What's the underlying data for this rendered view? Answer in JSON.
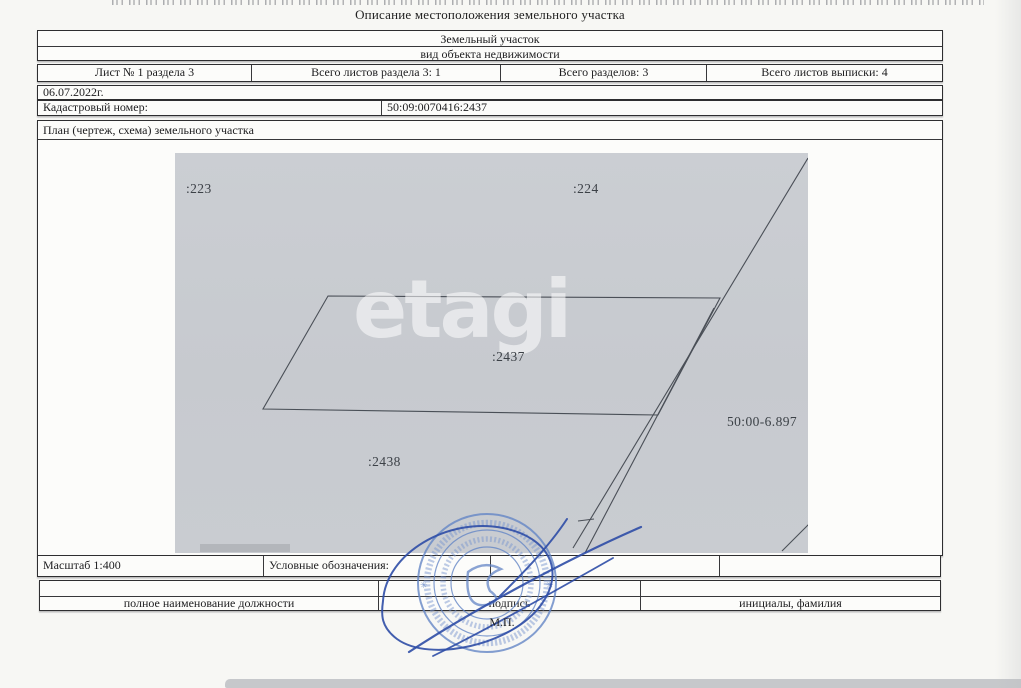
{
  "page": {
    "title": "Описание местоположения земельного участка"
  },
  "object_box": {
    "type": "Земельный участок",
    "caption": "вид объекта недвижимости"
  },
  "sheet_row": {
    "cells": [
      "Лист № 1 раздела 3",
      "Всего листов раздела 3: 1",
      "Всего разделов: 3",
      "Всего листов выписки: 4"
    ]
  },
  "date_row": {
    "value": "06.07.2022г."
  },
  "cadastral_row": {
    "label": "Кадастровый номер:",
    "value": "50:09:0070416:2437"
  },
  "plan": {
    "header": "План (чертеж, схема) земельного участка",
    "watermark": "etagi",
    "labels": {
      "parcel_223": ":223",
      "parcel_224": ":224",
      "parcel_2437": ":2437",
      "parcel_2438": ":2438",
      "boundary_zone": "50:00-6.897"
    }
  },
  "scale_row": {
    "scale": "Масштаб 1:400",
    "legend_label": "Условные обозначения:"
  },
  "signature_table": {
    "position_label": "полное наименование должности",
    "signature_label": "подпись",
    "name_label": "инициалы, фамилия",
    "seal_mark": "М.П."
  },
  "seal": {
    "star": "✳"
  },
  "colors": {
    "plan_bg": "#c8cbd0",
    "seal_blue": "#5b7fc0",
    "signature_blue": "#2e4da6",
    "border": "#2e2e30"
  }
}
